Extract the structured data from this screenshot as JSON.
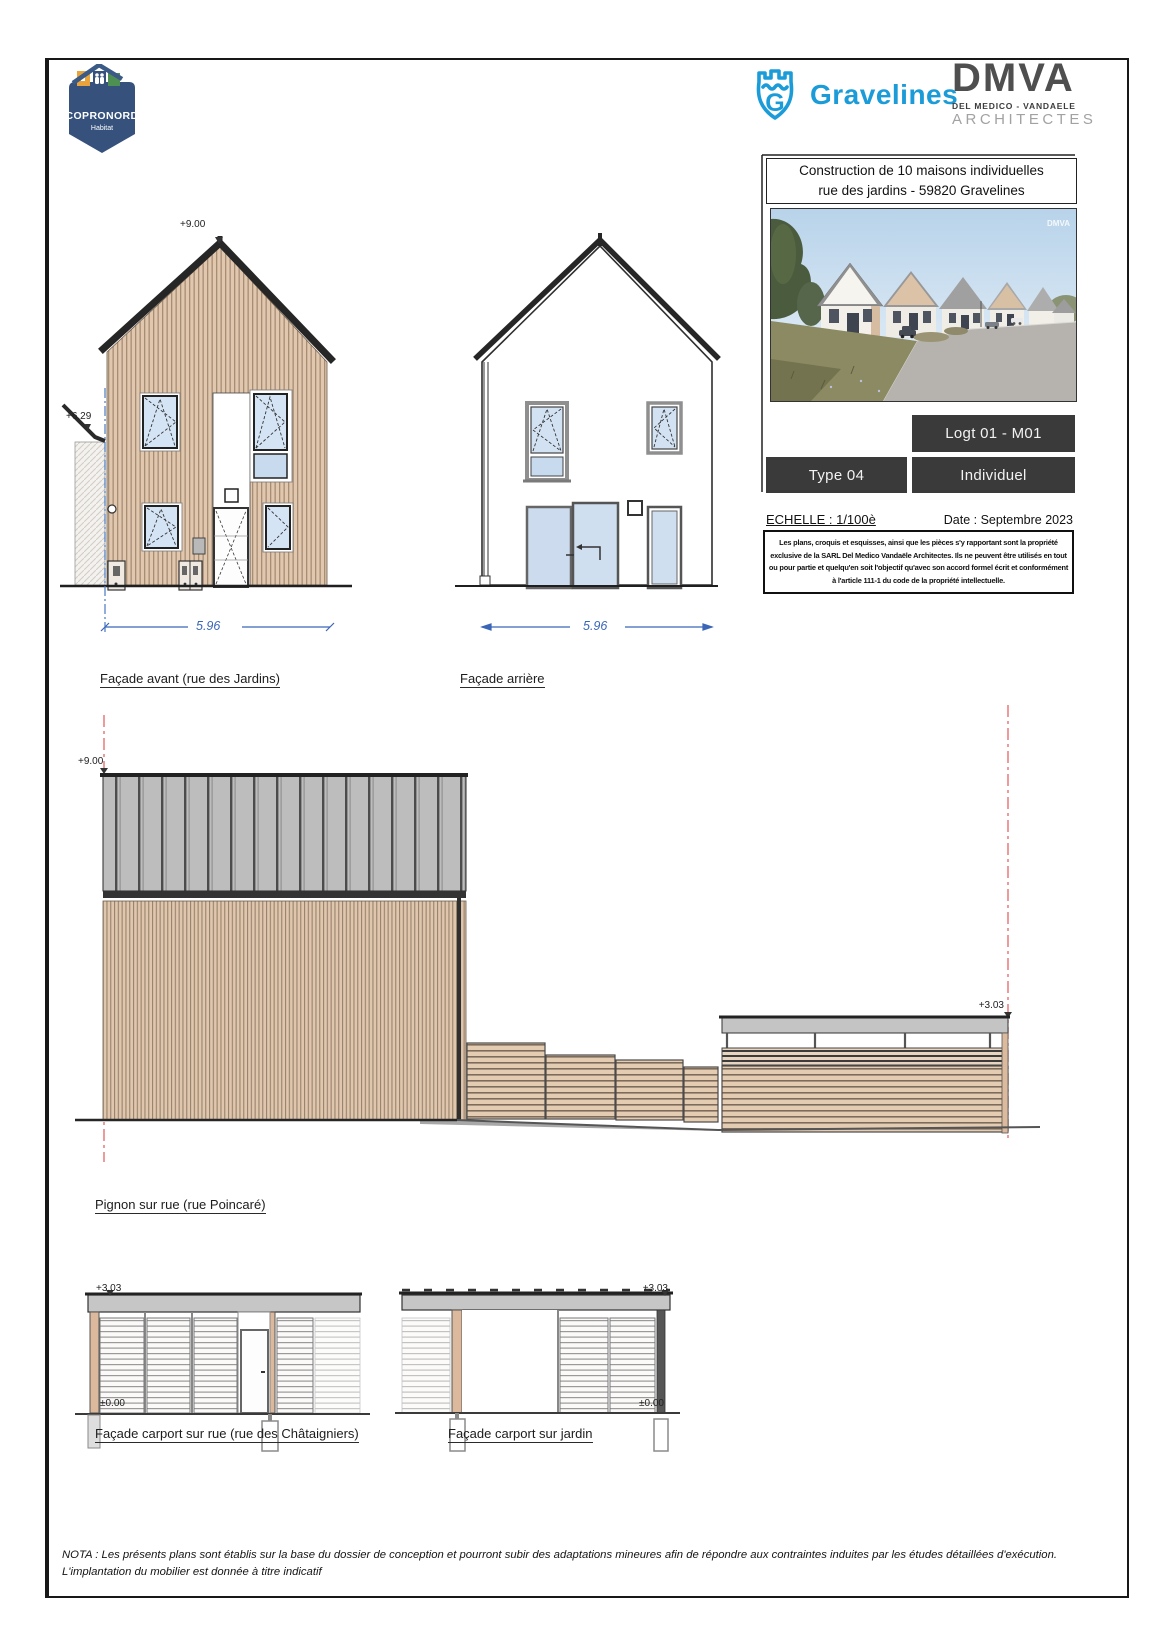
{
  "colors": {
    "accent_blue": "#1b9cd8",
    "dimension_blue": "#3a66b8",
    "level_line_red": "#e87070",
    "dark_box": "#3a3a3a",
    "copronord_navy": "#35517c",
    "wood_cladding": "#e0c7ae",
    "roof_gray": "#bdbdbd"
  },
  "logos": {
    "copronord": {
      "name": "COPRONORD",
      "subtitle": "Habitat"
    },
    "gravelines": {
      "label": "Gravelines"
    },
    "dmva": {
      "acronym": "DMVA",
      "line1": "DEL MEDICO - VANDAELE",
      "line2": "ARCHITECTES"
    }
  },
  "title_block": {
    "project_line1": "Construction de 10 maisons individuelles",
    "project_line2": "rue des jardins - 59820 Gravelines",
    "photo_watermark": "DMVA",
    "lot_label": "Logt 01 - M01",
    "type_label": "Type 04",
    "category_label": "Individuel",
    "scale_label": "ECHELLE : 1/100è",
    "date_label": "Date : Septembre 2023",
    "legal_lines": [
      "Les plans, croquis et esquisses, ainsi que les pièces s'y rapportant sont la propriété",
      "exclusive de la SARL Del Medico Vandaële Architectes. Ils ne peuvent être utilisés en tout",
      "ou pour partie et quelqu'en soit l'objectif qu'avec son accord formel écrit et conformément",
      "à l'article 111-1 du code de la propriété intellectuelle."
    ]
  },
  "drawings": {
    "facade_avant": {
      "label": "Façade avant (rue des Jardins)",
      "dimension": "5.96",
      "level_ridge": "+9.00",
      "level_neighbor": "+6.29"
    },
    "facade_arriere": {
      "label": "Façade arrière",
      "dimension": "5.96"
    },
    "pignon": {
      "label": "Pignon sur rue (rue Poincaré)",
      "level_ridge": "+9.00",
      "level_carport": "+3.03"
    },
    "carport_rue": {
      "label": "Façade carport sur rue (rue des Châtaigniers)",
      "level_roof": "+3.03",
      "level_ground": "±0.00"
    },
    "carport_jardin": {
      "label": "Façade carport sur jardin",
      "level_roof": "+3.03",
      "level_ground": "±0.00"
    }
  },
  "nota": {
    "line1": "NOTA : Les présents plans sont établis sur la base du dossier de conception et pourront subir des adaptations mineures afin de répondre aux contraintes induites par les études détaillées d'exécution.",
    "line2": "L'implantation du mobilier est donnée à titre indicatif"
  }
}
